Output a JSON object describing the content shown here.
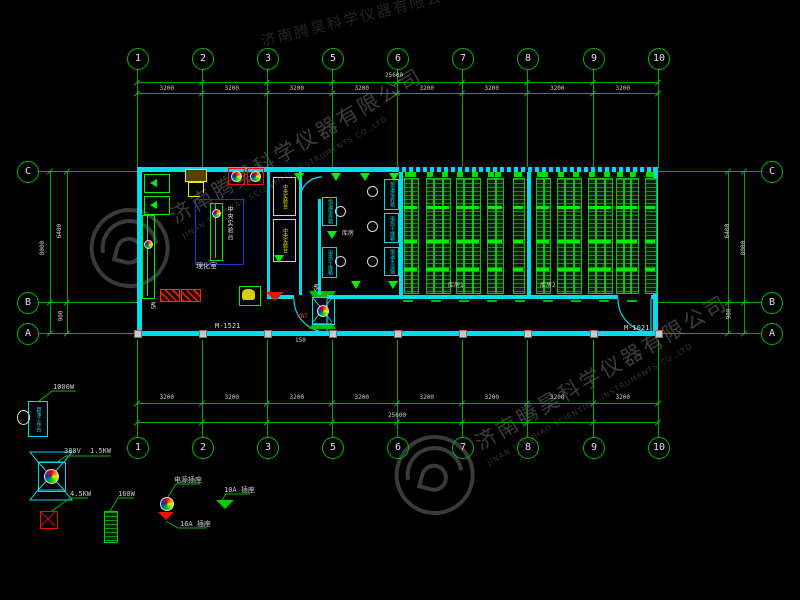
{
  "drawing": {
    "watermark": {
      "cn": "济南腾昊科学仪器有限公司",
      "en": "JINAN TENGHAO SCIENTIFIC INSTRUMENTS CO.,LTD"
    },
    "grid": {
      "columns": [
        "1",
        "2",
        "3",
        "5",
        "6",
        "7",
        "8",
        "9",
        "10"
      ],
      "rows": [
        "C",
        "B",
        "A"
      ]
    },
    "dimensions": {
      "top": {
        "segments": [
          "3200",
          "3200",
          "3200",
          "3200",
          "3200",
          "3200",
          "3200",
          "3200"
        ],
        "total": "25600"
      },
      "bottom": {
        "segments": [
          "3200",
          "3200",
          "3200",
          "3200",
          "3200",
          "3200",
          "3200",
          "3200"
        ],
        "total": "25600"
      },
      "left": {
        "overall": "8000",
        "upper": "6400",
        "lower": "900"
      },
      "right": {
        "overall": "8000",
        "upper": "6400",
        "lower": "900"
      }
    },
    "rooms": {
      "lab": "理化室",
      "middle": "库房",
      "storage1": "库房1",
      "storage2": "库房2"
    },
    "bench_label": "中央实验台",
    "doors": {
      "left": "M-1521",
      "right": "M-1021"
    },
    "annotations": {
      "ws": "WS",
      "xat": "XAT",
      "n150": "150"
    },
    "equipment_boxes": [
      "恒温培养箱",
      "电热干燥箱",
      "恒温培养箱",
      "电热干燥箱",
      "恒温水浴锅"
    ],
    "legend": {
      "ac": {
        "label": "1000W",
        "text": "超净工作台"
      },
      "fan": {
        "volt": "380V",
        "power": "1.5KW"
      },
      "heater": {
        "label": "4.5KW"
      },
      "rack": {
        "label": "160W"
      },
      "socket": {
        "label": "电源插座"
      },
      "socket16": {
        "label": "16A 插座"
      },
      "socket10": {
        "label": "10A 插座"
      }
    },
    "colors": {
      "line_green": "#00a800",
      "bright_green": "#00ee00",
      "wall_cyan": "#00dde8",
      "dim_text": "#cdcdcd",
      "yellow": "#e8e800",
      "red": "#ee1100",
      "blue": "#2233cc",
      "watermark": "#3d3d3d"
    }
  }
}
